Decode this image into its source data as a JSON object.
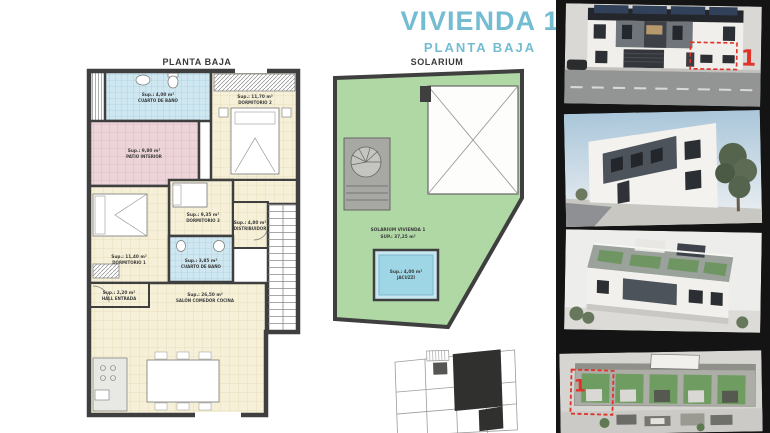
{
  "header": {
    "title": "VIVIENDA 1",
    "subtitle": "PLANTA BAJA"
  },
  "floor_plan": {
    "title": "PLANTA BAJA",
    "rooms": {
      "bath1": {
        "name": "CUARTO DE BAÑO",
        "area": "Sup.: 4,00 m²"
      },
      "dorm2": {
        "name": "DORMITORIO 2",
        "area": "Sup.: 11,70 m²"
      },
      "patio": {
        "name": "PATIO INTERIOR",
        "area": "Sup.: 9,80 m²"
      },
      "dorm3": {
        "name": "DORMITORIO 3",
        "area": "Sup.: 9,35 m²"
      },
      "distribuidor": {
        "name": "DISTRIBUIDOR",
        "area": "Sup.: 4,80 m²"
      },
      "dorm1": {
        "name": "DORMITORIO 1",
        "area": "Sup.: 11,40 m²"
      },
      "bath2": {
        "name": "CUARTO DE BAÑO",
        "area": "Sup.: 3,85 m²"
      },
      "hall": {
        "name": "HALL ENTRADA",
        "area": "Sup.: 2,20 m²"
      },
      "salon": {
        "name": "SALÓN COMEDOR COCINA",
        "area": "Sup.: 26,50 m²"
      }
    }
  },
  "solarium_plan": {
    "title": "SOLARIUM",
    "unit_label": "SOLARIUM VIVIENDA 1",
    "unit_area": "SUP.: 37,25 m²",
    "jacuzzi": {
      "name": "JACUZZI",
      "area": "Sup.: 4,00 m²"
    }
  },
  "markers": {
    "unit_number": "1"
  },
  "colors": {
    "accent_blue": "#74bcd2",
    "marker_red": "#e03228",
    "solarium_green": "#b0d8a4",
    "plan_cream": "#f6f0d8",
    "plan_pink": "#ecd4d8",
    "plan_blue": "#cfe7f0",
    "wall_dark": "#3f3f3f",
    "strip_black": "#141414"
  }
}
